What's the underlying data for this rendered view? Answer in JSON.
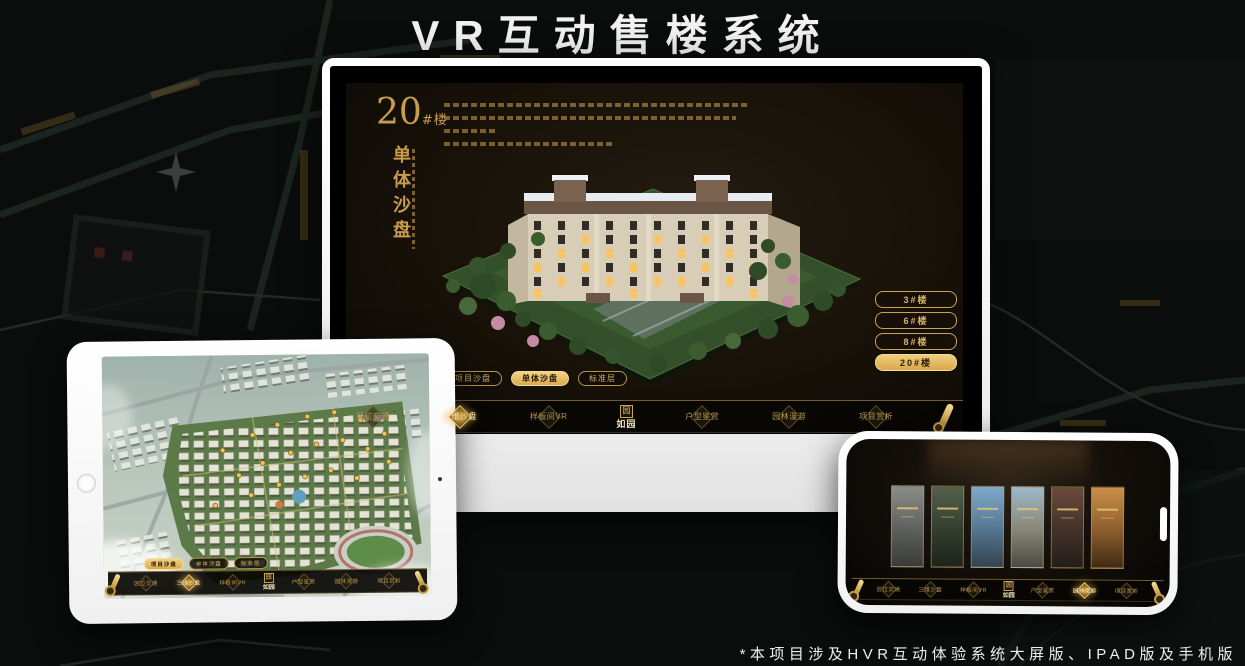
{
  "title": "VR互动售楼系统",
  "footnote": "*本项目涉及HVR互动体验系统大屏版、IPAD版及手机版",
  "brand": {
    "logo_name": "如园",
    "logo_seal": "园"
  },
  "monitor": {
    "block_no": "20",
    "block_unit": "#楼",
    "section_vertical_title": "单体沙盘",
    "floors": [
      {
        "label": "3#楼"
      },
      {
        "label": "6#楼"
      },
      {
        "label": "8#楼"
      },
      {
        "label": "20#楼"
      }
    ],
    "tabs": [
      {
        "label": "项目沙盘"
      },
      {
        "label": "单体沙盘"
      },
      {
        "label": "标准层"
      }
    ],
    "nav": [
      {
        "label": "区位交通"
      },
      {
        "label": "三维沙盘"
      },
      {
        "label": "样板间VR"
      },
      {
        "label": "户型鉴赏"
      },
      {
        "label": "园林漫游"
      },
      {
        "label": "项目赏析"
      }
    ]
  },
  "tablet": {
    "tabs": [
      {
        "label": "项目沙盘"
      },
      {
        "label": "单体沙盘"
      },
      {
        "label": "标准层"
      }
    ],
    "nav": [
      {
        "label": "区位交通"
      },
      {
        "label": "三维沙盘"
      },
      {
        "label": "样板间VR"
      },
      {
        "label": "户型鉴赏"
      },
      {
        "label": "园林漫游"
      },
      {
        "label": "项目赏析"
      }
    ]
  },
  "phone": {
    "nav": [
      {
        "label": "区位交通"
      },
      {
        "label": "三维沙盘"
      },
      {
        "label": "样板间VR"
      },
      {
        "label": "户型鉴赏"
      },
      {
        "label": "园林漫游"
      },
      {
        "label": "项目赏析"
      }
    ]
  },
  "colors": {
    "gold": "#d2a54f",
    "gold_bright": "#f0cd7c",
    "app_background": "#171108",
    "page_background": "#0a0d0b"
  }
}
